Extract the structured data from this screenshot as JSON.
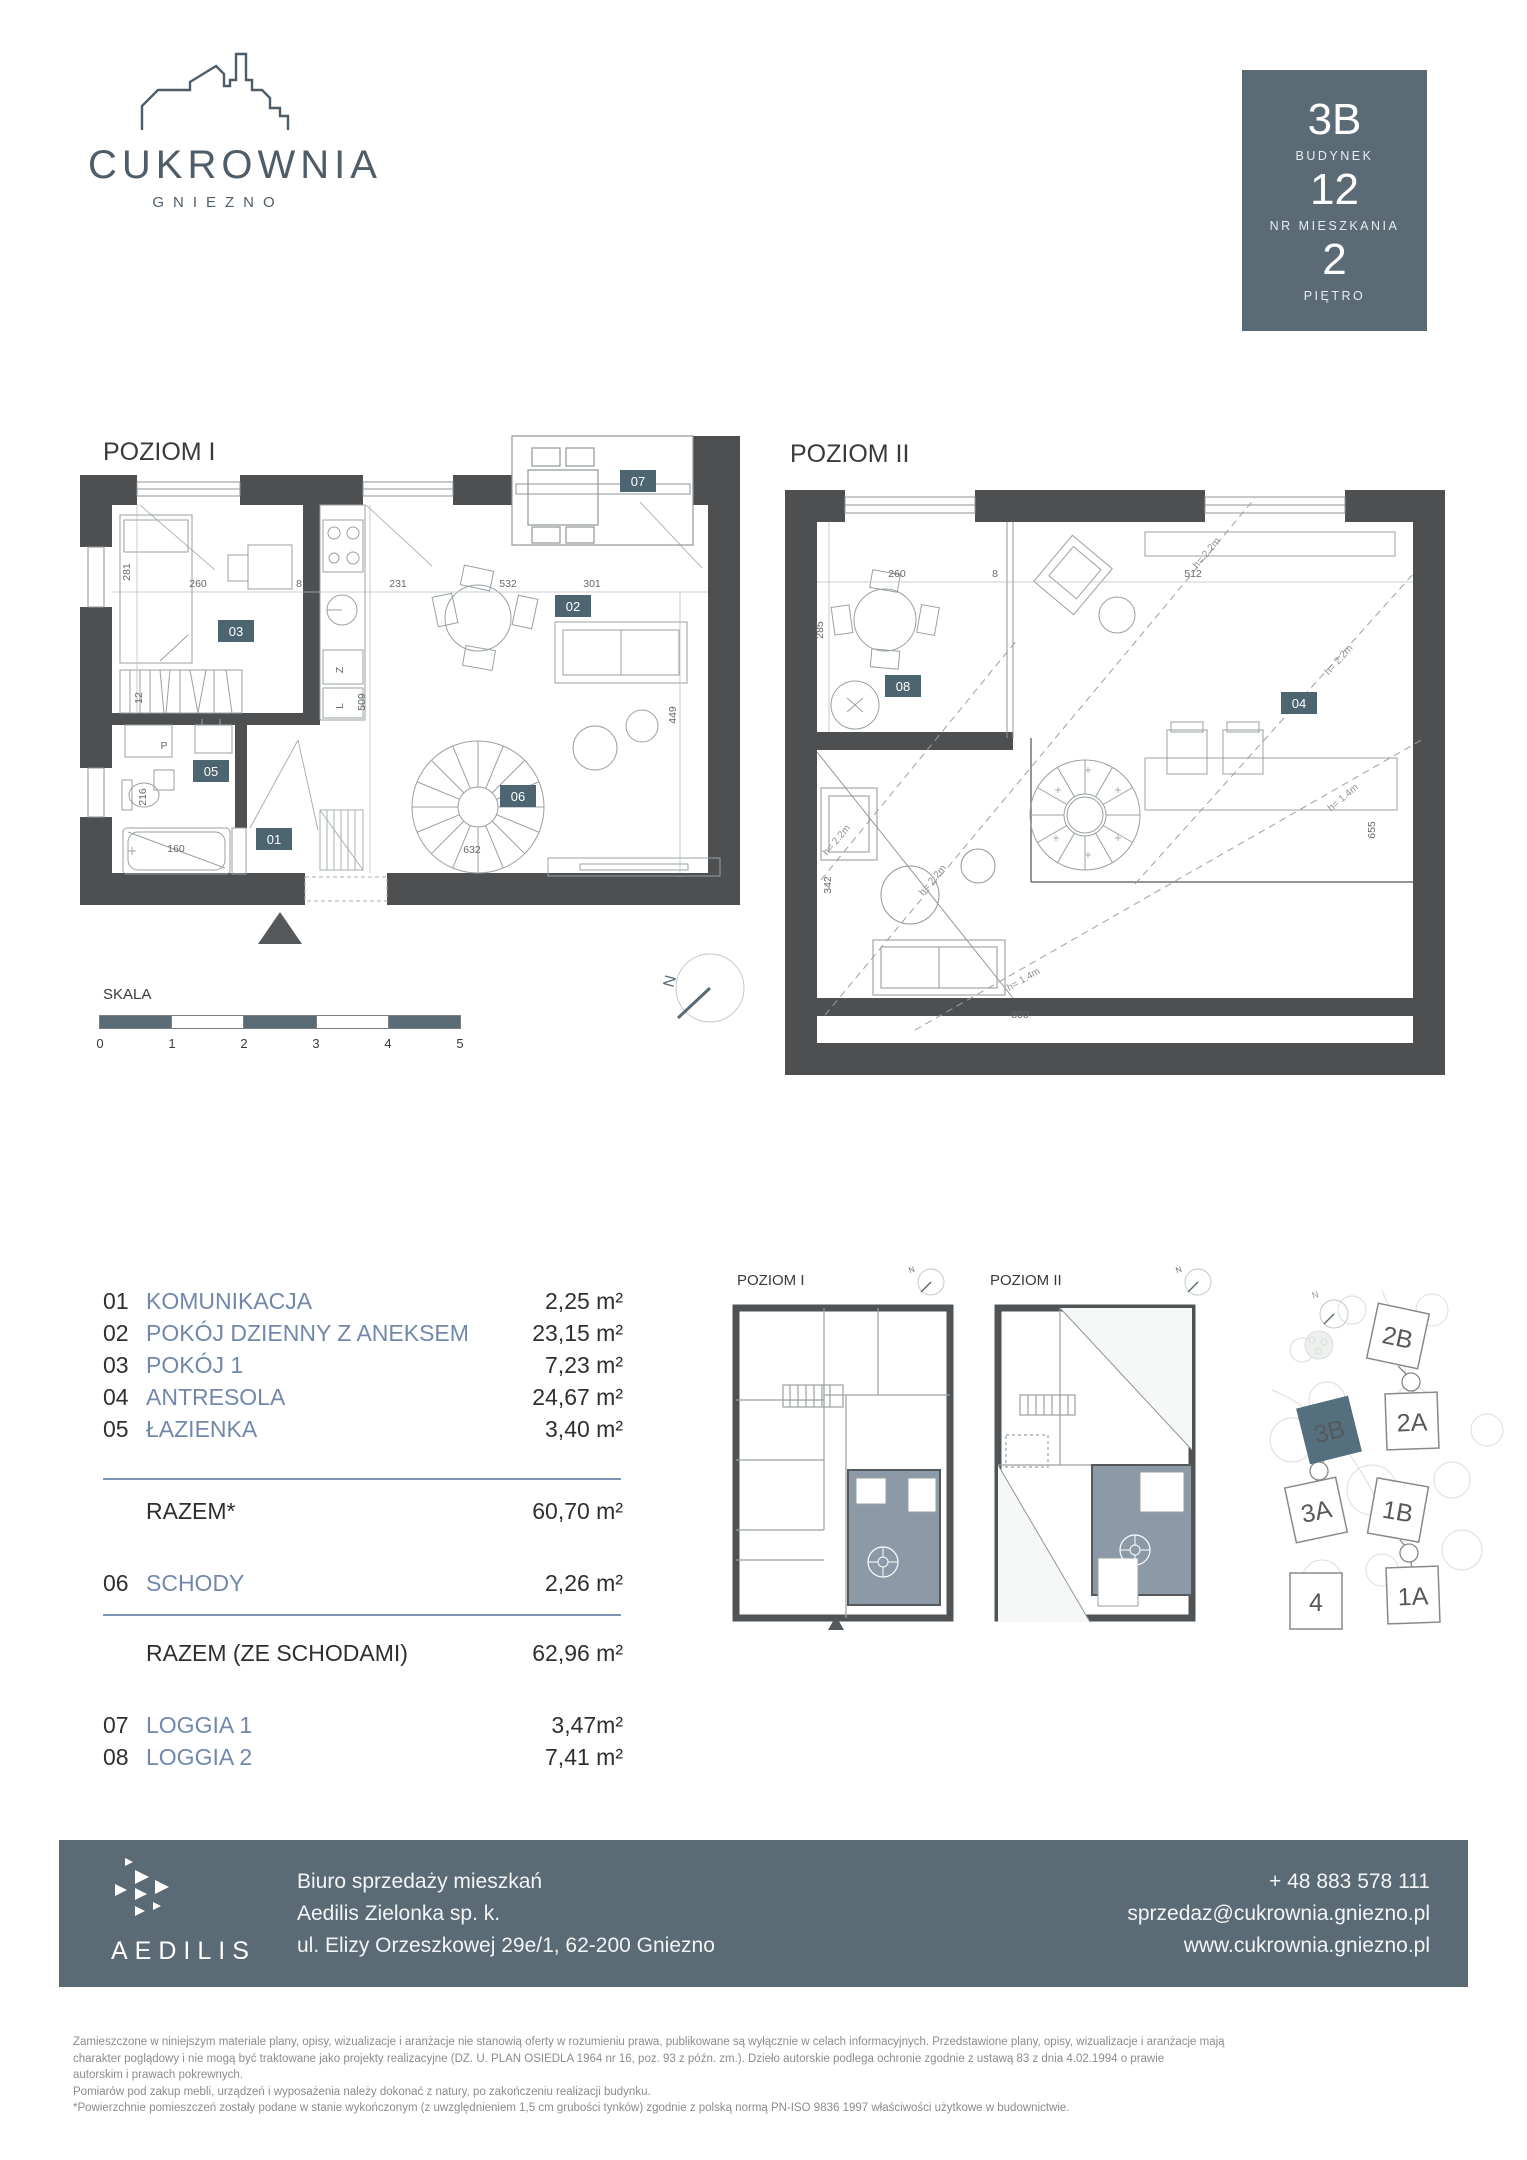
{
  "brand": {
    "name": "CUKROWNIA",
    "city": "GNIEZNO"
  },
  "unit_box": {
    "unit": "3B",
    "building_label": "BUDYNEK",
    "building_no": "12",
    "apartment_label": "NR MIESZKANIA",
    "apartment_no": "2",
    "floor_label": "PIĘTRO"
  },
  "plan1": {
    "title": "POZIOM I",
    "badges": {
      "b01": "01",
      "b02": "02",
      "b03": "03",
      "b05": "05",
      "b06": "06",
      "b07": "07"
    },
    "dims": {
      "d281": "281",
      "d12": "12",
      "d216": "216",
      "d160": "160",
      "d260": "260",
      "d8": "8",
      "d231": "231",
      "d532": "532",
      "d301": "301",
      "d509": "509",
      "d449": "449",
      "d632": "632"
    },
    "labels": {
      "p": "P",
      "z": "Z",
      "l": "L"
    }
  },
  "plan2": {
    "title": "POZIOM II",
    "badges": {
      "b04": "04",
      "b08": "08"
    },
    "dims": {
      "d285": "285",
      "d260": "260",
      "d8": "8",
      "d512": "512",
      "d342": "342",
      "d800": "800",
      "d655": "655"
    },
    "labels": {
      "h22": "h= 2.2m",
      "h14": "h= 1.4m"
    }
  },
  "compass": {
    "n": "N"
  },
  "scale": {
    "label": "SKALA",
    "ticks": [
      "0",
      "1",
      "2",
      "3",
      "4",
      "5"
    ]
  },
  "areas": {
    "rows": [
      {
        "no": "01",
        "name": "KOMUNIKACJA",
        "area": "2,25 m²"
      },
      {
        "no": "02",
        "name": "POKÓJ DZIENNY Z ANEKSEM",
        "area": "23,15 m²"
      },
      {
        "no": "03",
        "name": "POKÓJ 1",
        "area": "7,23 m²"
      },
      {
        "no": "04",
        "name": "ANTRESOLA",
        "area": "24,67 m²"
      },
      {
        "no": "05",
        "name": "ŁAZIENKA",
        "area": "3,40 m²"
      }
    ],
    "razem_label": "RAZEM*",
    "razem_area": "60,70 m²",
    "schody": {
      "no": "06",
      "name": "SCHODY",
      "area": "2,26 m²"
    },
    "razem2_label": "RAZEM (ZE SCHODAMI)",
    "razem2_area": "62,96 m²",
    "loggias": [
      {
        "no": "07",
        "name": "LOGGIA 1",
        "area": "3,47m²"
      },
      {
        "no": "08",
        "name": "LOGGIA 2",
        "area": "7,41 m²"
      }
    ]
  },
  "keyplans": {
    "plan1_title": "POZIOM I",
    "plan2_title": "POZIOM II"
  },
  "siteplan": {
    "b_2b": "2B",
    "b_2a": "2A",
    "b_3b": "3B",
    "b_3a": "3A",
    "b_1b": "1B",
    "b_4": "4",
    "b_1a": "1A"
  },
  "footer": {
    "logo_text": "AEDILIS",
    "office_line1": "Biuro sprzedaży mieszkań",
    "office_line2": "Aedilis Zielonka sp. k.",
    "office_line3": "ul. Elizy Orzeszkowej 29e/1, 62-200 Gniezno",
    "phone": "+ 48 883 578 111",
    "email": "sprzedaz@cukrownia.gniezno.pl",
    "website": "www.cukrownia.gniezno.pl"
  },
  "disclaimer": {
    "line1": "Zamieszczone w niniejszym materiale plany, opisy, wizualizacje i aranżacje nie stanowią oferty w rozumieniu prawa, publikowane są wyłącznie w celach informacyjnych. Przedstawione plany, opisy, wizualizacje i aranżacje mają",
    "line2": "charakter poglądowy i nie mogą być traktowane jako projekty realizacyjne (DZ. U. PLAN OSIEDLA 1964 nr 16, poz. 93 z późn. zm.). Dzieło autorskie podlega ochronie zgodnie z ustawą 83 z dnia 4.02.1994 o prawie",
    "line3": "autorskim i prawach pokrewnych.",
    "line4": "Pomiarów pod zakup mebli, urządzeń i wyposażenia należy dokonać z natury, po zakończeniu realizacji budynku.",
    "line5": "*Powierzchnie pomieszczeń zostały podane w stanie wykończonym (z uwzględnieniem 1,5 cm grubości tynków) zgodnie z polską normą PN-ISO 9836 1997 właściwości użytkowe w budownictwie."
  }
}
